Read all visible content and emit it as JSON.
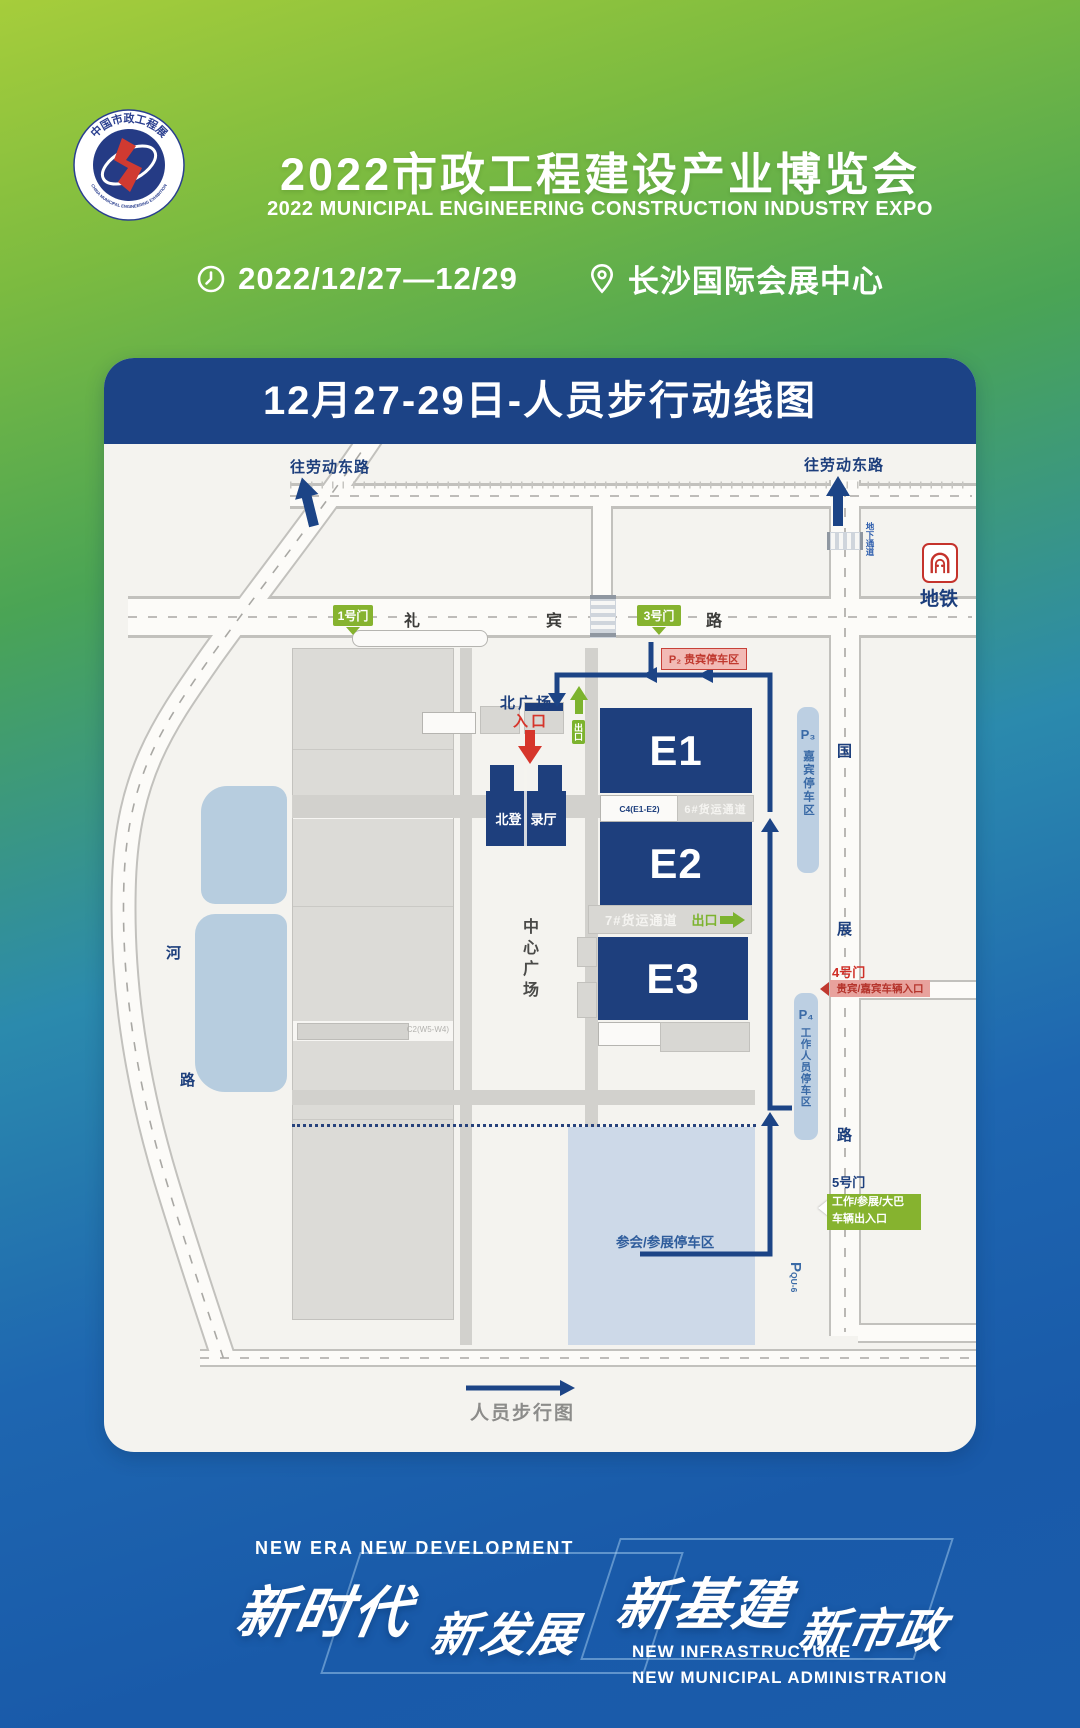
{
  "header": {
    "logo": {
      "ring_top": "中国市政工程展",
      "ring_bottom": "CHINA MUNICIPAL ENGINEERING EXHIBITION"
    },
    "title": "2022市政工程建设产业博览会",
    "subtitle": "2022 MUNICIPAL ENGINEERING CONSTRUCTION INDUSTRY EXPO",
    "date": "2022/12/27—12/29",
    "venue": "长沙国际会展中心"
  },
  "map": {
    "title": "12月27-29日-人员步行动线图",
    "legend": {
      "walk_label": "人员步行图"
    },
    "roads": {
      "to_laodong_left": "往劳动东路",
      "to_laodong_right": "往劳动东路",
      "libin": [
        "礼",
        "宾",
        "路"
      ],
      "guozhan": [
        "国",
        "展",
        "路"
      ],
      "hexi": [
        "河",
        "路"
      ],
      "underpass": "地下通道"
    },
    "metro_label": "地铁",
    "gates": {
      "g1": "1号门",
      "g3": "3号门",
      "g4": "4号门",
      "g5": "5号门"
    },
    "entrances": {
      "north_plaza": "北广场",
      "entry": "入口",
      "exit_north": "出口",
      "vip_vehicle": "贵宾/嘉宾车辆入口",
      "work_vehicle_line1": "工作/参展/大巴",
      "work_vehicle_line2": "车辆出入口",
      "exit_east": "出口"
    },
    "halls": {
      "e1": "E1",
      "e2": "E2",
      "e3": "E3",
      "reg_l": "北登",
      "reg_r": "录厅",
      "c4": "C4(E1-E2)",
      "cargo6": "6#货运通道",
      "cargo7": "7#货运通道",
      "w_label1": "C3(W1-W3)",
      "w_label2": "C2(W5-W4)"
    },
    "plaza": "中心广场",
    "parking": {
      "p2": "P₂ 贵宾停车区",
      "p3": "P₃",
      "p3_name": "嘉宾停车区",
      "p4": "P₄",
      "p4_name": "工作人员停车区",
      "p_qu6": "P",
      "p_qu6_code": "QU-6",
      "attendee": "参会/参展停车区"
    }
  },
  "footer": {
    "tagline_en": "NEW ERA  NEW DEVELOPMENT",
    "slogan": [
      "新时代",
      "新发展",
      "新基建",
      "新市政"
    ],
    "sub_en1": "NEW INFRASTRUCTURE",
    "sub_en2": "NEW MUNICIPAL ADMINISTRATION"
  },
  "colors": {
    "navy": "#1c4386",
    "hall_navy": "#1e3f7d",
    "green": "#86b32f",
    "red": "#cf2f27",
    "pink": "#f2bab5",
    "strip_blue": "#bccfe2",
    "parking_blue": "#cdd9e8",
    "text_blue": "#3a6aa6"
  }
}
